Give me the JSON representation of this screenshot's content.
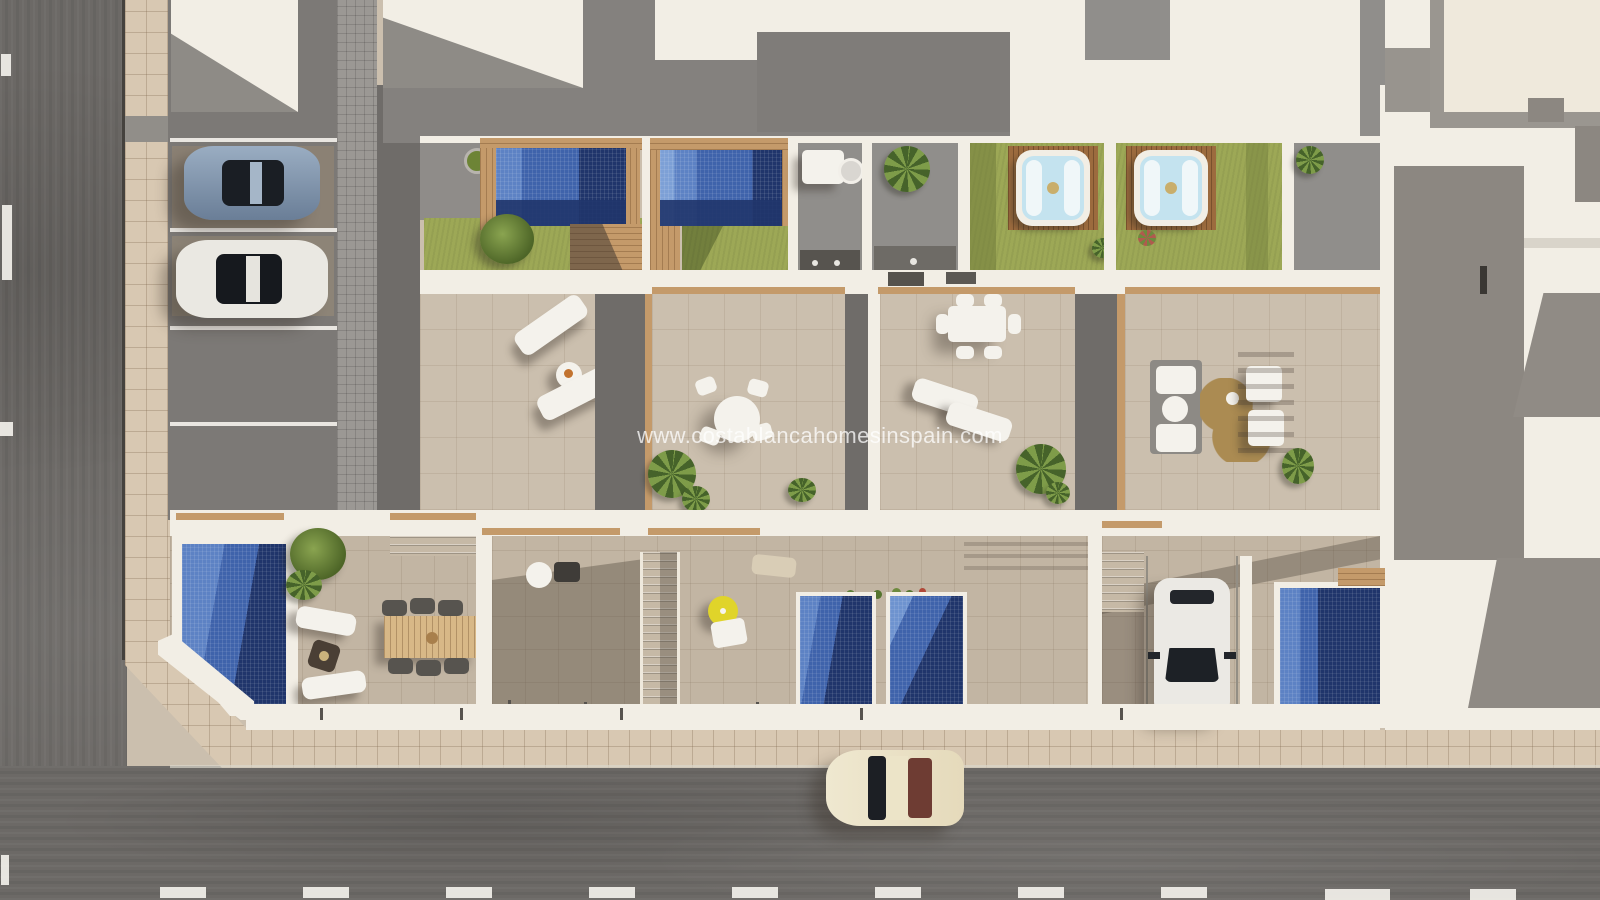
{
  "meta": {
    "title": "Aerial 3D render - coastal townhouse development site plan"
  },
  "watermark": {
    "text": "www.costablancahomesinspain.com"
  },
  "palette": {
    "road": "#6c6966",
    "lane-mark": "#f2f0ea",
    "sidewalk": "#d8c8b2",
    "parking": "#7c7976",
    "paver": "#9b9894",
    "alley": "#6f6c69",
    "tile": "#cbbfae",
    "tile-dim": "#c2b5a3",
    "white-wall": "#f2eee5",
    "roof-gray": "#908e8b",
    "roof-gray-dark": "#84817e",
    "gray-box": "#7f7c79",
    "lawn": "#9da856",
    "lawn-shadow": "#75813e",
    "wood": "#c49a6a",
    "deck-dark": "#9c6b3e",
    "pool-light": "#5d82c4",
    "pool-mid": "#3f63ab",
    "pool-dark": "#20356b",
    "tub-water": "#c4e3ef",
    "furn-white": "#f4f2ec",
    "furn-dark": "#57544f",
    "rug": "#ab8b52",
    "parasol": "#e0d42a",
    "car-blue": "#8aa0b8",
    "car-white": "#ebe9e4",
    "car-cream": "#ece4c8",
    "car-glass": "#1d2126",
    "shadow": "rgba(55,48,40,0.38)"
  }
}
